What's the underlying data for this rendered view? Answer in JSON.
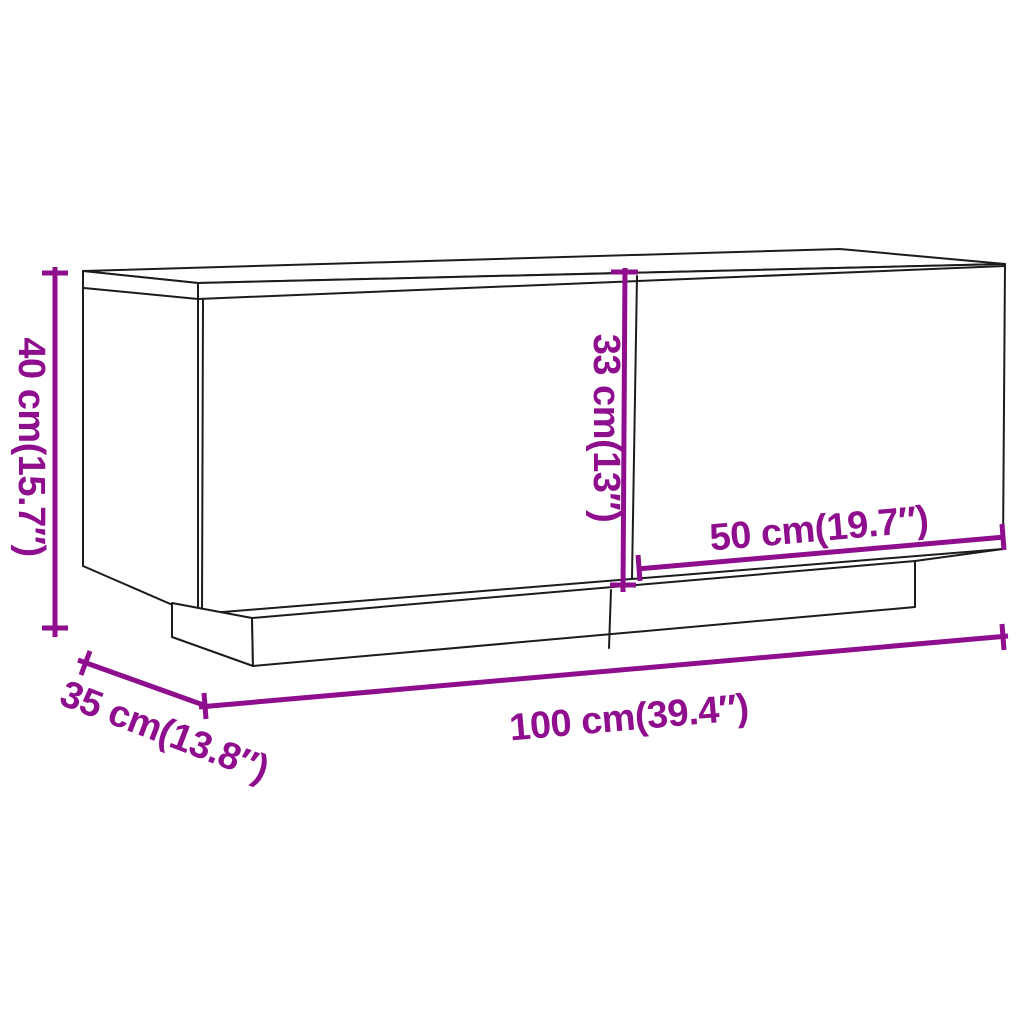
{
  "page": {
    "background_color": "#FFFFFF",
    "description": "Line-art dimension diagram of a two-door TV cabinet on a recessed plinth, drawn in three-quarter perspective"
  },
  "diagram": {
    "accent_color": "#8E0E8E",
    "outline_color": "#1C1C1C",
    "unit_style": "centimeters with inches in parentheses",
    "dimensions": [
      {
        "id": "overall-height",
        "label": "40 cm(15.7″)",
        "placement": "left edge, vertical"
      },
      {
        "id": "door-height",
        "label": "33 cm(13″)",
        "placement": "vertical, along door divider"
      },
      {
        "id": "right-door-width",
        "label": "50 cm(19.7″)",
        "placement": "above bottom edge of right door"
      },
      {
        "id": "overall-width",
        "label": "100 cm(39.4″)",
        "placement": "below cabinet front"
      },
      {
        "id": "depth",
        "label": "35 cm(13.8″)",
        "placement": "lower left, along depth direction"
      }
    ]
  }
}
